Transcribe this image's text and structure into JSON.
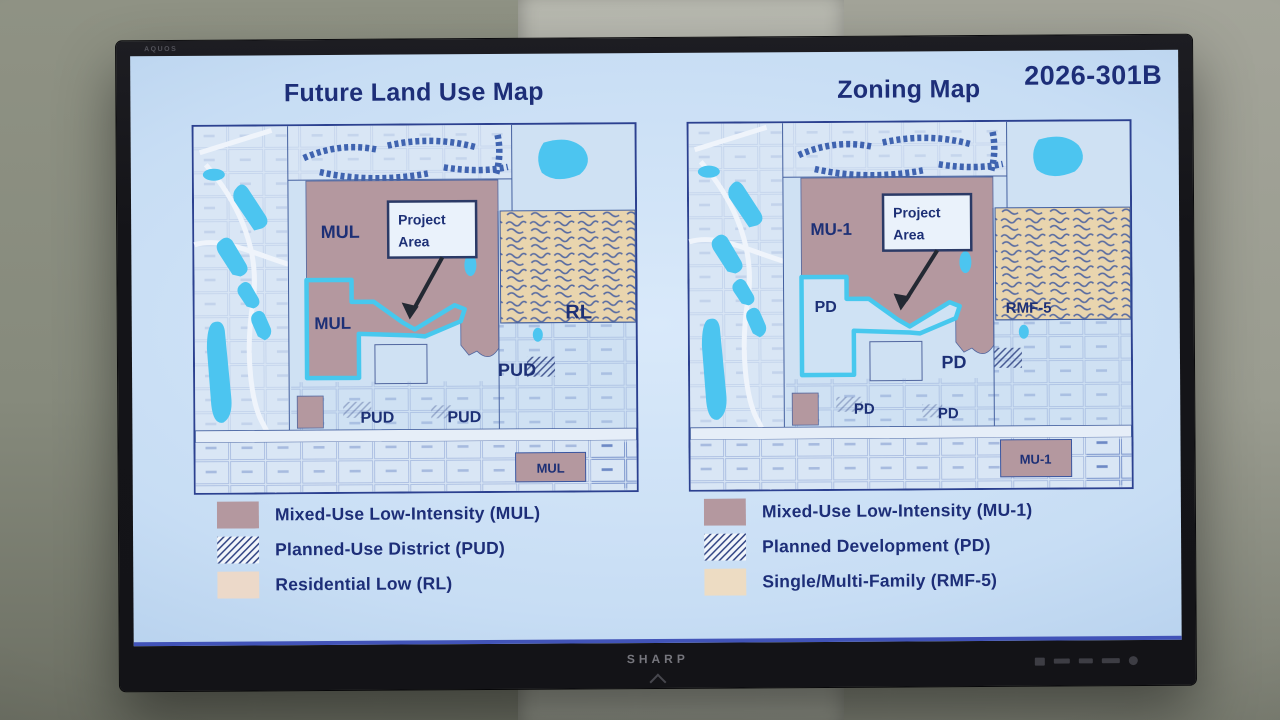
{
  "monitor": {
    "brand": "SHARP",
    "badge": "AQUOS"
  },
  "slide": {
    "doc_number": "2026-301B",
    "left": {
      "title": "Future Land Use Map"
    },
    "right": {
      "title": "Zoning Map"
    }
  },
  "maps": {
    "left": {
      "callout": {
        "line1": "Project",
        "line2": "Area"
      },
      "labels": {
        "zone_top": "MUL",
        "lobe": "MUL",
        "residential": "RL",
        "mid_right": "PUD",
        "bottom_a": "PUD",
        "bottom_b": "PUD",
        "bottom_strip": "MUL"
      }
    },
    "right": {
      "callout": {
        "line1": "Project",
        "line2": "Area"
      },
      "labels": {
        "zone_top": "MU-1",
        "lobe": "PD",
        "residential": "RMF-5",
        "mid_right": "PD",
        "bottom_a": "PD",
        "bottom_b": "PD",
        "bottom_strip": "MU-1"
      }
    }
  },
  "legends": {
    "left": {
      "items": [
        {
          "key": "mul",
          "label": "Mixed-Use Low-Intensity (MUL)"
        },
        {
          "key": "pud",
          "label": "Planned-Use District (PUD)"
        },
        {
          "key": "rl",
          "label": "Residential Low (RL)"
        }
      ]
    },
    "right": {
      "items": [
        {
          "key": "mu1",
          "label": "Mixed-Use Low-Intensity (MU-1)"
        },
        {
          "key": "pd",
          "label": "Planned Development (PD)"
        },
        {
          "key": "rmf5",
          "label": "Single/Multi-Family (RMF-5)"
        }
      ]
    }
  },
  "colors": {
    "mauve": "#b4989f",
    "lobe_right": "#cfe2f4",
    "lake": "#4cc5f0",
    "residential_area": "#e9d5ae",
    "rl_swatch": "#ecd9c9",
    "rmf_swatch": "#eddcc3",
    "outline_cyan": "#47c8ee",
    "navy_text": "#1d2e78"
  }
}
